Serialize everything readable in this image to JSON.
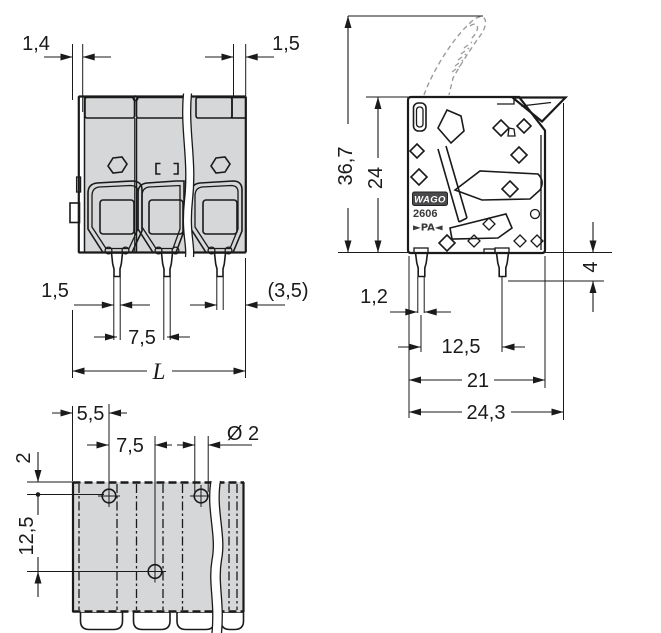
{
  "views": {
    "front": {
      "name": "front-view",
      "dims": {
        "top_left": "1,4",
        "top_right": "1,5",
        "pin_width": "1,5",
        "end_offset": "(3,5)",
        "pitch": "7,5",
        "length": "L"
      }
    },
    "side": {
      "name": "side-view",
      "dims": {
        "overall_height": "36,7",
        "housing_height": "24",
        "pin_length": "4",
        "pin_width": "1,2",
        "pin_row_spacing": "12,5",
        "housing_depth": "21",
        "overall_depth": "24,3"
      },
      "markings": {
        "brand": "WAGO",
        "series": "2606",
        "material": "►PA◄"
      }
    },
    "bottom": {
      "name": "bottom-view",
      "dims": {
        "edge_to_hole": "5,5",
        "pitch": "7,5",
        "hole_diameter": "Ø 2",
        "row_offset": "2",
        "row_spacing": "12,5"
      }
    }
  },
  "colors": {
    "orange": "#EE8620",
    "housing_gray": "#D6D7D8",
    "line_dark": "#1A1A1A",
    "phantom_gray": "#9C9C9C",
    "logo_bg": "#4A4A4C"
  }
}
